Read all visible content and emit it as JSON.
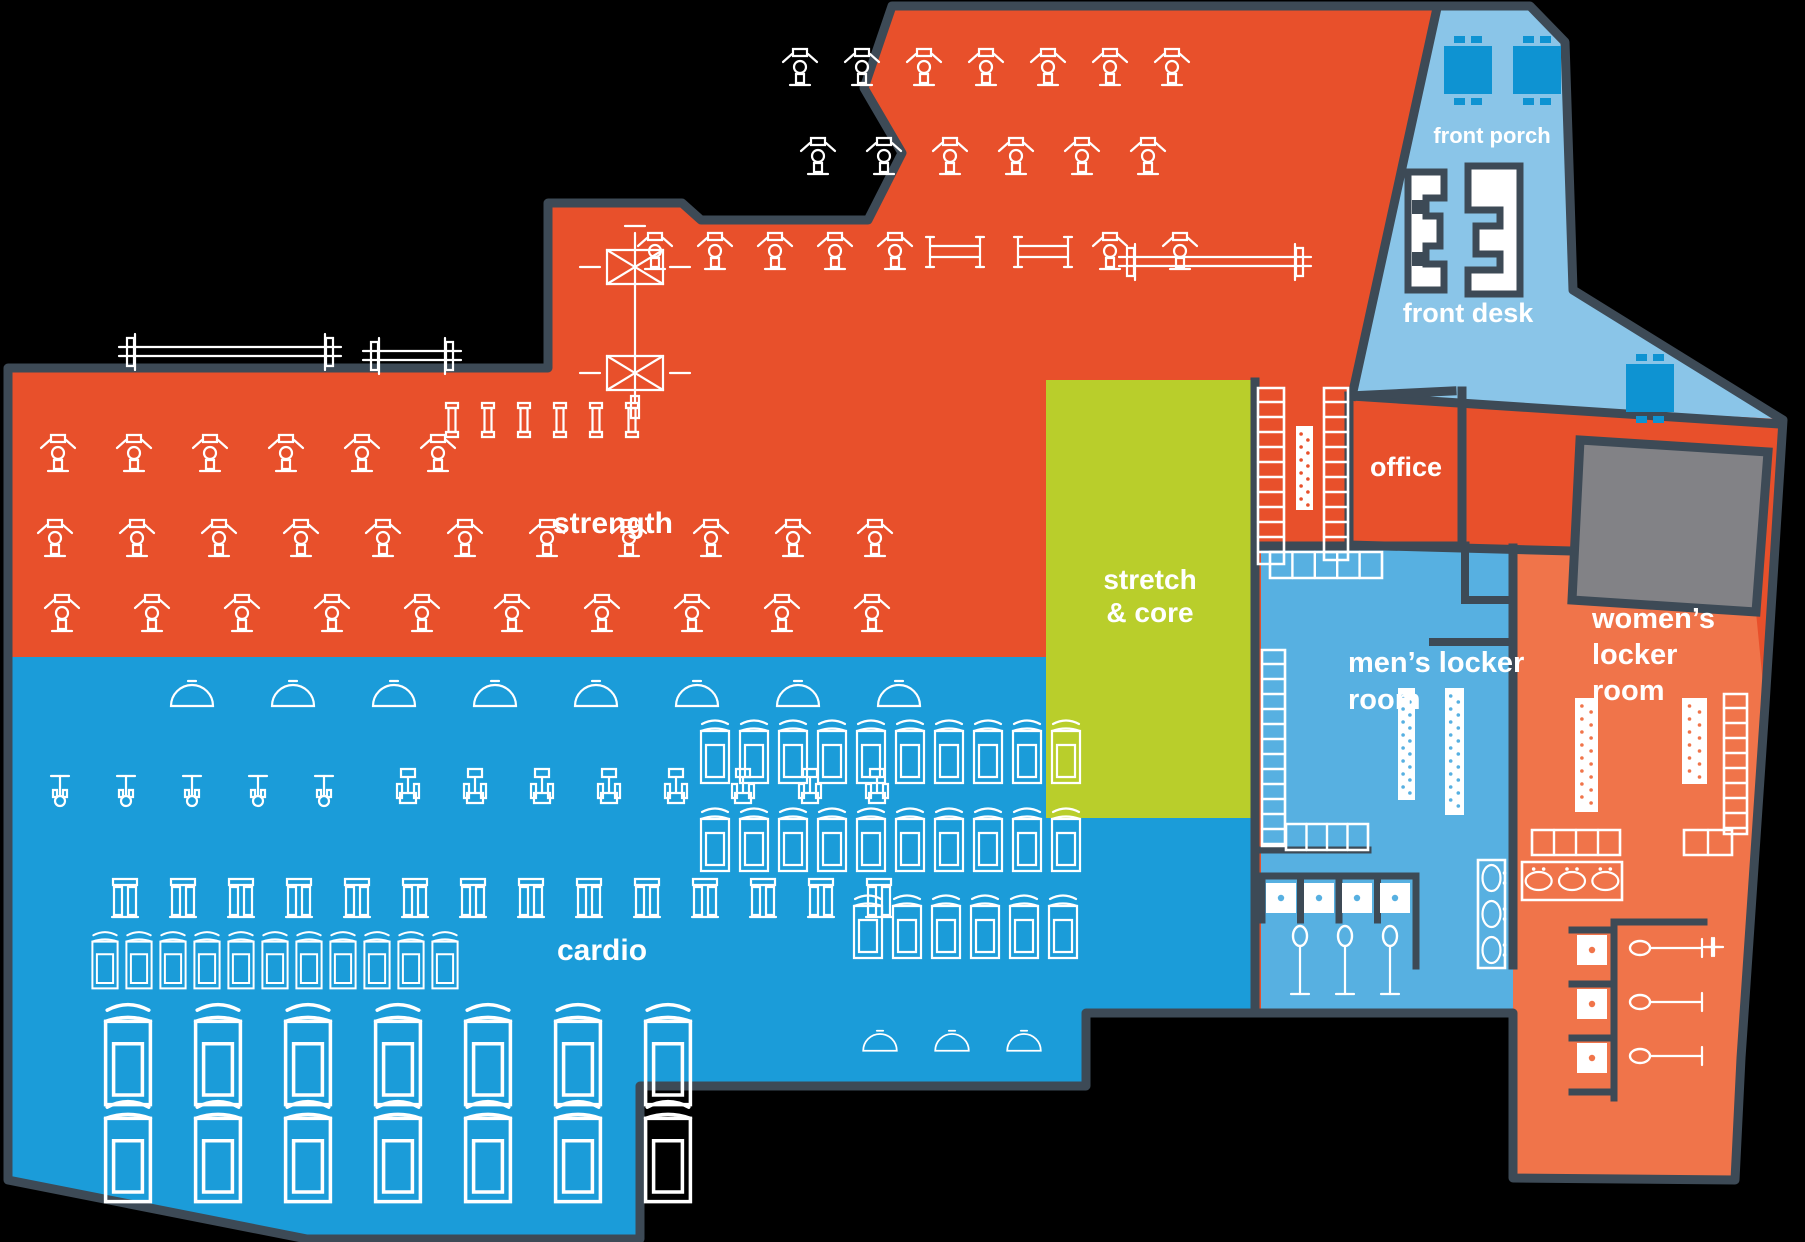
{
  "map_title": "gym floor plan",
  "colors": {
    "background": "#000000",
    "wall": "#3D4A56",
    "strength_red": "#E8502B",
    "cardio_blue": "#1B9CD9",
    "locker_blue": "#57B0E1",
    "porch_blue": "#8AC5E8",
    "furniture_blue": "#0E93D2",
    "stretch_green": "#B9CE2B",
    "gray_room": "#828286",
    "womens_orange": "#F0744A",
    "icon_white": "#FFFFFF"
  },
  "zones": {
    "strength": {
      "label": "strength"
    },
    "cardio": {
      "label": "cardio"
    },
    "stretch_core": {
      "label": "stretch & core"
    },
    "front_porch": {
      "label": "front porch"
    },
    "front_desk": {
      "label": "front desk"
    },
    "office": {
      "label": "office"
    },
    "mens_locker": {
      "label": "men’s locker room"
    },
    "womens_locker": {
      "label": "women’s locker room"
    }
  },
  "labels": [
    {
      "id": "strength",
      "lines": [
        "strength"
      ],
      "x": 613,
      "y": 533,
      "size": 30,
      "anchor": "middle",
      "lh": 34
    },
    {
      "id": "cardio",
      "lines": [
        "cardio"
      ],
      "x": 602,
      "y": 960,
      "size": 30,
      "anchor": "middle",
      "lh": 34
    },
    {
      "id": "stretch-core",
      "lines": [
        "stretch",
        "& core"
      ],
      "x": 1150,
      "y": 589,
      "size": 28,
      "anchor": "middle",
      "lh": 33
    },
    {
      "id": "front-porch",
      "lines": [
        "front porch"
      ],
      "x": 1492,
      "y": 143,
      "size": 22,
      "anchor": "middle",
      "lh": 26
    },
    {
      "id": "front-desk",
      "lines": [
        "front desk"
      ],
      "x": 1468,
      "y": 322,
      "size": 27,
      "anchor": "middle",
      "lh": 30
    },
    {
      "id": "office",
      "lines": [
        "office"
      ],
      "x": 1406,
      "y": 476,
      "size": 27,
      "anchor": "middle",
      "lh": 30
    },
    {
      "id": "mens-locker",
      "lines": [
        "men’s locker",
        "room"
      ],
      "x": 1348,
      "y": 672,
      "size": 29,
      "anchor": "start",
      "lh": 37
    },
    {
      "id": "womens-locker",
      "lines": [
        "women’s",
        "locker",
        "room"
      ],
      "x": 1592,
      "y": 628,
      "size": 29,
      "anchor": "start",
      "lh": 36
    }
  ],
  "equipment_rows": [
    {
      "type": "machine",
      "x": 800,
      "y": 66,
      "count": 7,
      "step": 62
    },
    {
      "type": "machine",
      "x": 818,
      "y": 155,
      "count": 6,
      "step": 66
    },
    {
      "type": "machine",
      "x": 655,
      "y": 250,
      "count": 5,
      "step": 60
    },
    {
      "type": "bench",
      "x": 955,
      "y": 252,
      "count": 2,
      "step": 88
    },
    {
      "type": "machine",
      "x": 1110,
      "y": 250,
      "count": 2,
      "step": 70
    },
    {
      "type": "rack",
      "x": 230,
      "y": 352,
      "count": 1,
      "step": 0,
      "w": 190
    },
    {
      "type": "rack",
      "x": 412,
      "y": 356,
      "count": 1,
      "step": 0,
      "w": 66
    },
    {
      "type": "rack",
      "x": 1215,
      "y": 262,
      "count": 1,
      "step": 0,
      "w": 160
    },
    {
      "type": "dumbbell",
      "x": 452,
      "y": 420,
      "count": 6,
      "step": 36
    },
    {
      "type": "machine",
      "x": 58,
      "y": 452,
      "count": 6,
      "step": 76
    },
    {
      "type": "cable",
      "x": 635,
      "y": 318,
      "count": 1,
      "step": 0
    },
    {
      "type": "machine",
      "x": 55,
      "y": 537,
      "count": 11,
      "step": 82
    },
    {
      "type": "machine",
      "x": 62,
      "y": 612,
      "count": 10,
      "step": 90
    },
    {
      "type": "fan",
      "x": 192,
      "y": 700,
      "count": 8,
      "step": 101
    },
    {
      "type": "spinbike",
      "x": 60,
      "y": 790,
      "count": 5,
      "step": 66
    },
    {
      "type": "bike",
      "x": 408,
      "y": 788,
      "count": 8,
      "step": 67
    },
    {
      "type": "elliptical",
      "x": 125,
      "y": 900,
      "count": 14,
      "step": 58
    },
    {
      "type": "treadmill",
      "x": 105,
      "y": 965,
      "count": 11,
      "step": 34,
      "s": 0.9
    },
    {
      "type": "treadmill",
      "x": 128,
      "y": 1063,
      "count": 7,
      "step": 90,
      "s": 1.6
    },
    {
      "type": "treadmill",
      "x": 128,
      "y": 1160,
      "count": 7,
      "step": 90,
      "s": 1.6
    },
    {
      "type": "treadmill",
      "x": 715,
      "y": 757,
      "count": 10,
      "step": 39,
      "s": 1.0
    },
    {
      "type": "treadmill",
      "x": 715,
      "y": 845,
      "count": 10,
      "step": 39,
      "s": 1.0
    },
    {
      "type": "treadmill",
      "x": 868,
      "y": 932,
      "count": 6,
      "step": 39,
      "s": 1.0
    },
    {
      "type": "fan",
      "x": 880,
      "y": 1046,
      "count": 3,
      "step": 72,
      "s": 0.8
    }
  ],
  "porch_furniture": {
    "tables": 3,
    "table_positions": [
      [
        1468,
        70
      ],
      [
        1537,
        70
      ],
      [
        1650,
        388
      ]
    ]
  },
  "locker_fixtures": {
    "mens": {
      "lockers": 4,
      "benches": 2,
      "toilets": 4,
      "showers": 3,
      "sink_basins": 3
    },
    "womens": {
      "lockers": 4,
      "benches": 2,
      "toilets": 3,
      "showers": 3,
      "sink_basins": 3
    },
    "corridor": {
      "lockers": 2,
      "benches": 1
    }
  }
}
